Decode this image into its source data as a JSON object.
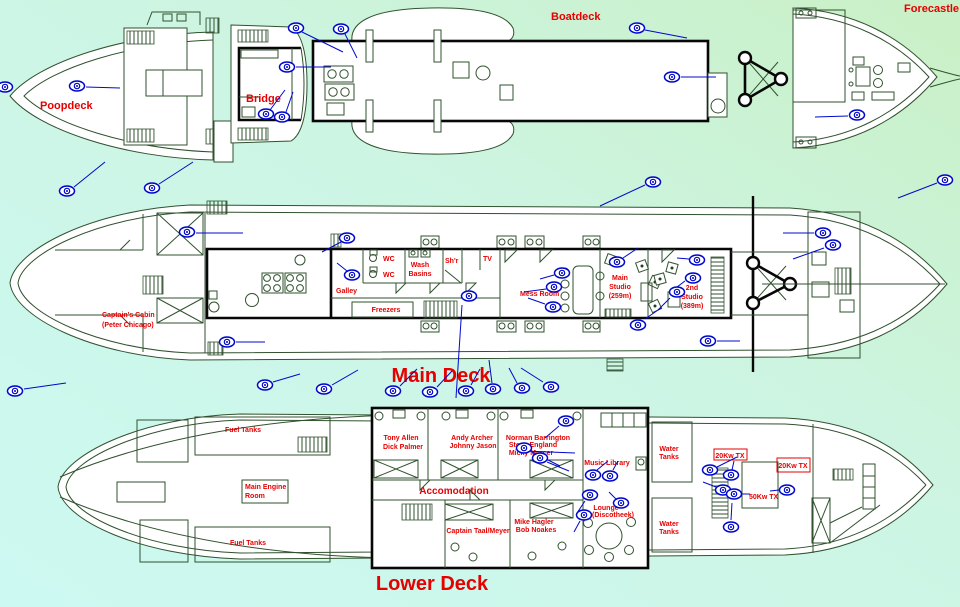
{
  "colors": {
    "background_left_cyan": "#ccf9f2",
    "background_right_green": "#c9f0c5",
    "label_red": "#e60000",
    "outline_green": "#31512f",
    "structure_black": "#070707",
    "viewpoint_blue": "#0008cc"
  },
  "decks": {
    "poopdeck": {
      "label": "Poopdeck"
    },
    "bridge": {
      "label": "Bridge"
    },
    "boatdeck": {
      "label": "Boatdeck"
    },
    "forecastle": {
      "label": "Forecastle"
    },
    "main": {
      "title": "Main Deck",
      "rooms": {
        "captains_cabin": [
          "Captain's Cabin",
          "(Peter Chicago)"
        ],
        "galley": "Galley",
        "wc_1": "WC",
        "wc_2": "WC",
        "wash_basins": [
          "Wash",
          "Basins"
        ],
        "shower": "Sh'r",
        "tv": "TV",
        "mess_room": "Mess Room",
        "main_studio": [
          "Main",
          "Studio",
          "(259m)"
        ],
        "second_studio": [
          "2nd",
          "Studio",
          "(389m)"
        ],
        "freezers": "Freezers"
      }
    },
    "lower": {
      "title": "Lower Deck",
      "rooms": {
        "fuel_tanks_top": "Fuel Tanks",
        "fuel_tanks_bottom": "Fuel Tanks",
        "main_engine_room": [
          "Main Engine",
          "Room"
        ],
        "accomodation": "Accomodation",
        "cabin_tony_allen": [
          "Tony Allen",
          "Dick Palmer"
        ],
        "cabin_andy_archer": [
          "Andy Archer",
          "Johnny Jason"
        ],
        "cabin_norman": [
          "Norman Barrington",
          "Steve England",
          "Micky Mercer"
        ],
        "cabin_captain": "Captain Taal/Meyer",
        "cabin_mike": [
          "Mike Hagler",
          "Bob Noakes"
        ],
        "music_library": "Music Library",
        "lounge": [
          "Lounge",
          "(Discotheek)"
        ],
        "water_tanks_top": [
          "Water",
          "Tanks"
        ],
        "water_tanks_bottom": [
          "Water",
          "Tanks"
        ],
        "tx_20kw_a": "20Kw TX",
        "tx_20kw_b": "20Kw TX",
        "tx_50kw": "50Kw TX"
      }
    }
  },
  "viewpoints": [
    [
      5,
      87
    ],
    [
      77,
      86
    ],
    [
      296,
      28
    ],
    [
      341,
      29
    ],
    [
      287,
      67
    ],
    [
      266,
      114
    ],
    [
      282,
      117
    ],
    [
      637,
      28
    ],
    [
      672,
      77
    ],
    [
      857,
      115
    ],
    [
      67,
      191
    ],
    [
      152,
      188
    ],
    [
      653,
      182
    ],
    [
      945,
      180
    ],
    [
      187,
      232
    ],
    [
      347,
      238
    ],
    [
      352,
      275
    ],
    [
      469,
      296
    ],
    [
      562,
      273
    ],
    [
      554,
      287
    ],
    [
      553,
      307
    ],
    [
      617,
      262
    ],
    [
      697,
      260
    ],
    [
      693,
      278
    ],
    [
      677,
      292
    ],
    [
      638,
      325
    ],
    [
      708,
      341
    ],
    [
      823,
      233
    ],
    [
      833,
      245
    ],
    [
      227,
      342
    ],
    [
      15,
      391
    ],
    [
      265,
      385
    ],
    [
      324,
      389
    ],
    [
      393,
      391
    ],
    [
      430,
      392
    ],
    [
      466,
      391
    ],
    [
      493,
      389
    ],
    [
      522,
      388
    ],
    [
      551,
      387
    ],
    [
      566,
      421
    ],
    [
      524,
      448
    ],
    [
      540,
      458
    ],
    [
      593,
      475
    ],
    [
      610,
      476
    ],
    [
      590,
      495
    ],
    [
      621,
      503
    ],
    [
      584,
      515
    ],
    [
      710,
      470
    ],
    [
      731,
      475
    ],
    [
      723,
      490
    ],
    [
      734,
      494
    ],
    [
      731,
      527
    ],
    [
      787,
      490
    ]
  ],
  "leader_lines": [
    [
      86,
      87,
      120,
      88
    ],
    [
      302,
      32,
      343,
      52
    ],
    [
      345,
      34,
      357,
      58
    ],
    [
      296,
      67,
      331,
      67
    ],
    [
      270,
      110,
      285,
      90
    ],
    [
      286,
      112,
      293,
      92
    ],
    [
      645,
      30,
      687,
      38
    ],
    [
      681,
      77,
      716,
      77
    ],
    [
      815,
      117,
      848,
      116
    ],
    [
      74,
      187,
      105,
      162
    ],
    [
      159,
      184,
      193,
      162
    ],
    [
      600,
      206,
      645,
      185
    ],
    [
      898,
      198,
      937,
      183
    ],
    [
      196,
      233,
      243,
      233
    ],
    [
      322,
      252,
      341,
      242
    ],
    [
      337,
      263,
      347,
      271
    ],
    [
      462,
      305,
      456,
      398
    ],
    [
      540,
      279,
      554,
      275
    ],
    [
      524,
      292,
      546,
      289
    ],
    [
      528,
      298,
      545,
      304
    ],
    [
      623,
      258,
      638,
      248
    ],
    [
      677,
      258,
      689,
      259
    ],
    [
      673,
      290,
      685,
      281
    ],
    [
      658,
      310,
      670,
      298
    ],
    [
      645,
      319,
      661,
      308
    ],
    [
      717,
      341,
      740,
      341
    ],
    [
      783,
      233,
      814,
      233
    ],
    [
      793,
      259,
      824,
      248
    ],
    [
      236,
      342,
      265,
      342
    ],
    [
      24,
      389,
      66,
      383
    ],
    [
      273,
      382,
      300,
      374
    ],
    [
      332,
      385,
      358,
      370
    ],
    [
      400,
      386,
      417,
      369
    ],
    [
      437,
      387,
      452,
      371
    ],
    [
      471,
      385,
      480,
      369
    ],
    [
      492,
      383,
      489,
      360
    ],
    [
      517,
      383,
      509,
      368
    ],
    [
      543,
      382,
      521,
      368
    ],
    [
      545,
      438,
      559,
      426
    ],
    [
      532,
      452,
      560,
      466
    ],
    [
      524,
      451,
      575,
      453
    ],
    [
      547,
      462,
      569,
      471
    ],
    [
      597,
      470,
      608,
      461
    ],
    [
      613,
      470,
      618,
      461
    ],
    [
      585,
      501,
      577,
      513
    ],
    [
      616,
      499,
      609,
      492
    ],
    [
      580,
      521,
      574,
      532
    ],
    [
      717,
      467,
      737,
      457
    ],
    [
      732,
      470,
      734,
      461
    ],
    [
      716,
      487,
      703,
      482
    ],
    [
      741,
      494,
      750,
      494
    ],
    [
      731,
      520,
      732,
      503
    ],
    [
      770,
      491,
      779,
      490
    ]
  ]
}
